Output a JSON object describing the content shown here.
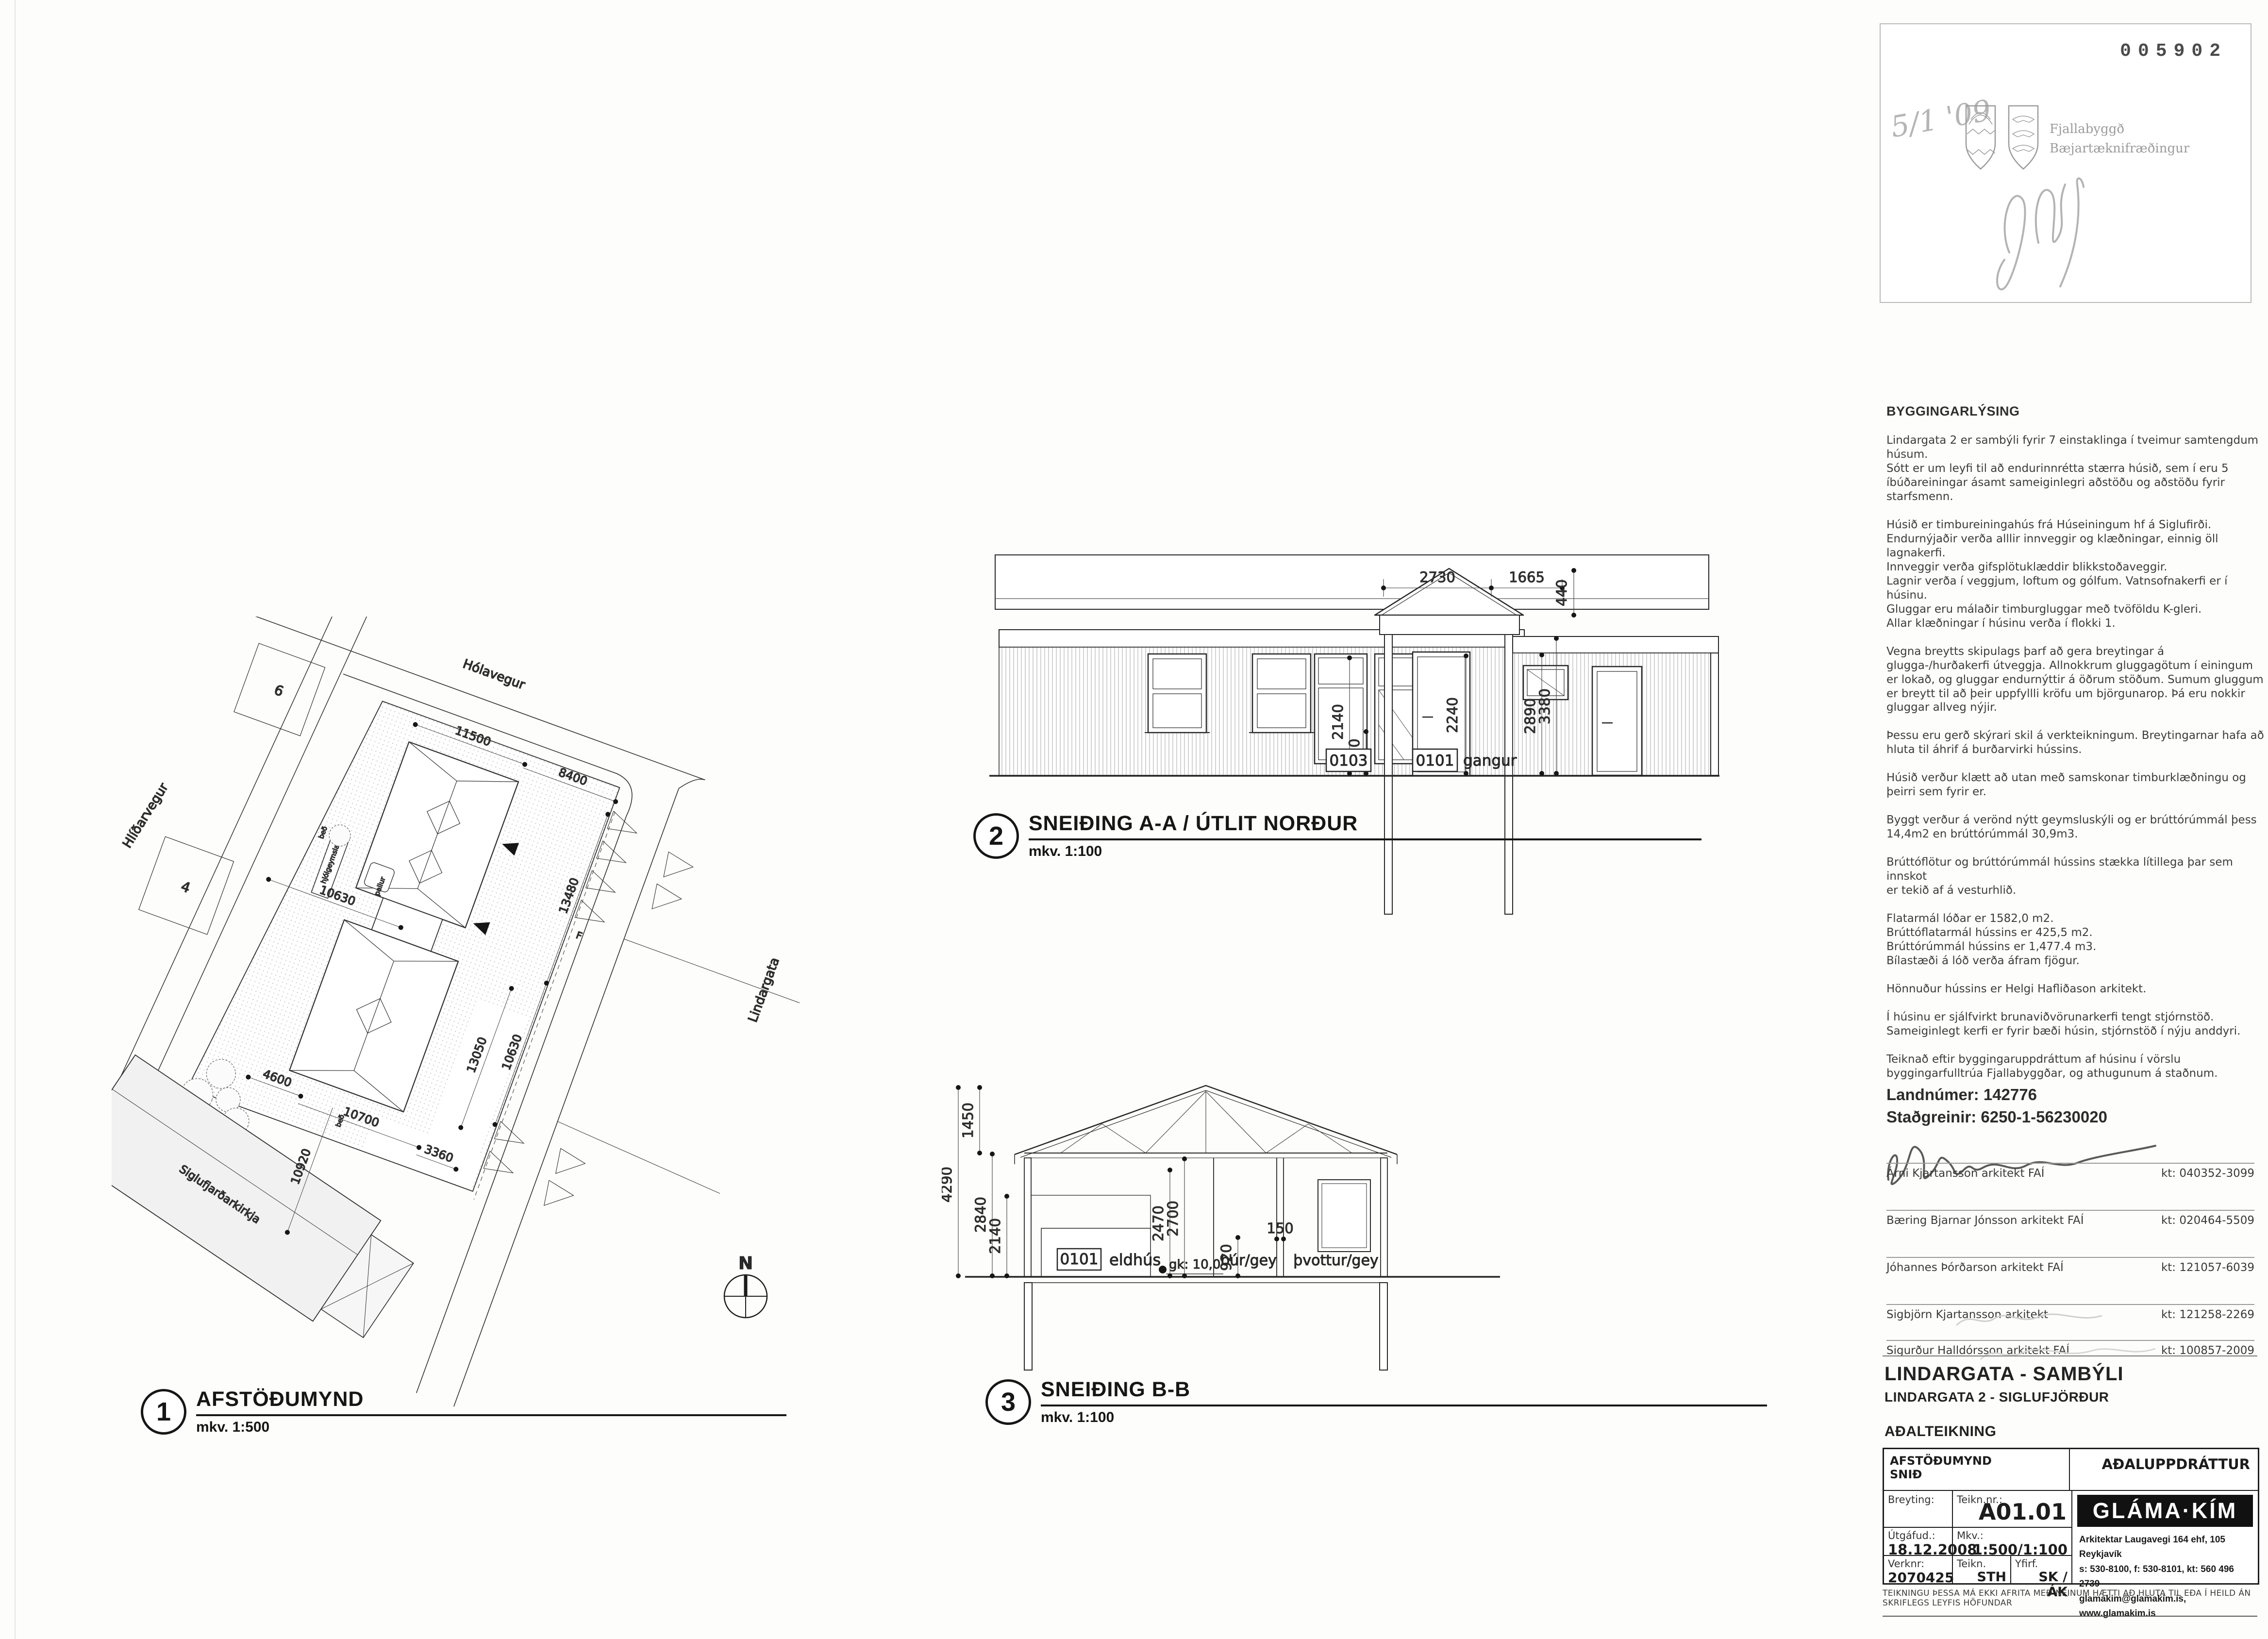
{
  "stamp": {
    "number": "005902",
    "date_note": "5/1 '09",
    "org1": "Fjallabyggð",
    "org2": "Bæjartæknifræðingur"
  },
  "bygg": {
    "title": "BYGGINGARLÝSING",
    "groups": [
      "Lindargata 2 er sambýli fyrir 7 einstaklinga í tveimur samtengdum\nhúsum.\nSótt er um leyfi til að endurinnrétta stærra húsið, sem í eru 5\níbúðareiningar ásamt sameiginlegri aðstöðu og aðstöðu fyrir\nstarfsmenn.",
      "Húsið er timbureiningahús frá Húseiningum hf á Siglufirði.\nEndurnýjaðir verða alllir innveggir og klæðningar, einnig öll\nlagnakerfi.\nInnveggir verða gifsplötuklæddir blikkstoðaveggir.\nLagnir verða í veggjum, loftum og gólfum.  Vatnsofnakerfi er í\nhúsinu.\nGluggar eru málaðir timburgluggar með tvöföldu K-gleri.\nAllar klæðningar í húsinu verða í flokki 1.",
      "Vegna breytts skipulags þarf að gera breytingar á\nglugga-/hurðakerfi útveggja. Allnokkrum gluggagötum í einingum\ner lokað, og gluggar endurnýttir á öðrum stöðum. Sumum gluggum\ner breytt til að þeir uppfyllli kröfu um björgunarop. Þá eru nokkir\ngluggar allveg nýjir.",
      "Þessu eru gerð skýrari skil á verkteikningum. Breytingarnar hafa að\nhluta til áhrif á burðarvirki hússins.",
      "Húsið verður klætt að utan með samskonar timburklæðningu og\nþeirri sem fyrir er.",
      "Byggt verður á verönd nýtt geymsluskýli og er brúttórúmmál þess\n14,4m2 en brúttórúmmál 30,9m3.",
      "Brúttóflötur og brúttórúmmál hússins stækka lítillega þar sem innskot\ner tekið af á vesturhlið.",
      "Flatarmál lóðar er 1582,0 m2.\nBrúttóflatarmál hússins er 425,5 m2.\nBrúttórúmmál hússins er 1,477.4 m3.\nBílastæði á lóð verða áfram fjögur.",
      "Hönnuður hússins er Helgi Hafliðason arkitekt.",
      "Í húsinu er sjálfvirkt brunaviðvörunarkerfi tengt stjórnstöð.\nSameiginlegt kerfi er fyrir bæði húsin, stjórnstöð í nýju anddyri.",
      "Teiknað eftir byggingaruppdráttum af húsinu í vörslu\nbyggingarfulltrúa Fjallabyggðar, og athugunum á staðnum."
    ]
  },
  "land": {
    "line1": "Landnúmer: 142776",
    "line2": "Staðgreinir: 6250-1-56230020"
  },
  "signatures": [
    {
      "name": "Árni Kjartansson  arkitekt FAÍ",
      "kt": "kt: 040352-3099"
    },
    {
      "name": "Bæring Bjarnar Jónsson arkitekt FAÍ",
      "kt": "kt: 020464-5509"
    },
    {
      "name": "Jóhannes Þórðarson arkitekt FAÍ",
      "kt": "kt: 121057-6039"
    },
    {
      "name": "Sigbjörn Kjartansson arkitekt",
      "kt": "kt: 121258-2269"
    },
    {
      "name": "Sigurður Halldórsson arkitekt FAÍ",
      "kt": "kt: 100857-2009"
    }
  ],
  "titleblock": {
    "project": "LINDARGATA - SAMBÝLI",
    "address": "LINDARGATA 2 - SIGLUFJÖRÐUR",
    "doctype": "AÐALTEIKNING",
    "content1": "AFSTÖÐUMYND",
    "content2": "SNIÐ",
    "class_label": "AÐALUPPDRÁTTUR",
    "breyting_label": "Breyting:",
    "teiknnr_label": "Teikn.nr.:",
    "sheet_no": "A01.01",
    "utgafud_label": "Útgáfud.:",
    "date": "18.12.2008",
    "mkv_label": "Mkv.:",
    "scale": "1:500/1:100",
    "verknr_label": "Verknr:",
    "verknr": "2070425",
    "teikn_label": "Teikn.",
    "teikn": "STH",
    "yfirf_label": "Yfirf.",
    "yfirf": "SK / ÁK",
    "firm": "GLÁMA·KÍM",
    "addr1": "Arkitektar Laugavegi 164 ehf, 105 Reykjavík",
    "addr2": "s: 530-8100, f: 530-8101, kt: 560 496 2739",
    "addr3": "glamakim@glamakim.is,  www.glamakim.is",
    "disclaimer": "TEIKNINGU ÞESSA MÁ EKKI AFRITA MEÐ NEINUM HÆTTI AÐ HLUTA TIL EÐA Í HEILD ÁN SKRIFLEGS LEYFIS HÖFUNDAR"
  },
  "figures": {
    "f1": {
      "num": "1",
      "title": "AFSTÖÐUMYND",
      "scale": "mkv. 1:500"
    },
    "f2": {
      "num": "2",
      "title": "SNEIÐING A-A / ÚTLIT NORÐUR",
      "scale": "mkv. 1:100"
    },
    "f3": {
      "num": "3",
      "title": "SNEIÐING B-B",
      "scale": "mkv. 1:100"
    }
  },
  "siteplan": {
    "streets": {
      "top": "Hólavegur",
      "left": "Hlíðarvegur",
      "right": "Lindargata"
    },
    "church": "Siglufjarðarkirkja",
    "plots": {
      "p6": "6",
      "p4": "4"
    },
    "small": {
      "pallur": "pallur",
      "hjolgeymsla": "hjólgeymsla",
      "bed": "beð",
      "f": "F"
    },
    "dims": {
      "d11500": "11500",
      "d8400": "8400",
      "d13480": "13480",
      "d10630r": "10630",
      "d10630l": "10630",
      "d13050": "13050",
      "d4600": "4600",
      "d10700": "10700",
      "d3360": "3360",
      "d10920": "10920"
    },
    "north": "N"
  },
  "sectionAA": {
    "dims": {
      "d2730": "2730",
      "d1665": "1665",
      "d440": "440",
      "d2240": "2240",
      "d2140": "2140",
      "d920": "920",
      "d2890": "2890",
      "d3380": "3380"
    },
    "tags": {
      "t0103": "0103",
      "t0101": "0101",
      "gangur": "gangur"
    }
  },
  "sectionBB": {
    "dims": {
      "d1450": "1450",
      "d4290": "4290",
      "d2840": "2840",
      "d2140": "2140",
      "d2470": "2470",
      "d2700": "2700",
      "d920": "920",
      "d150": "150",
      "gk": "gk: 10,0"
    },
    "tags": {
      "t0101": "0101",
      "eldhus": "eldhús",
      "bur": "búr/gey",
      "thvottur": "þvottur/gey"
    }
  }
}
